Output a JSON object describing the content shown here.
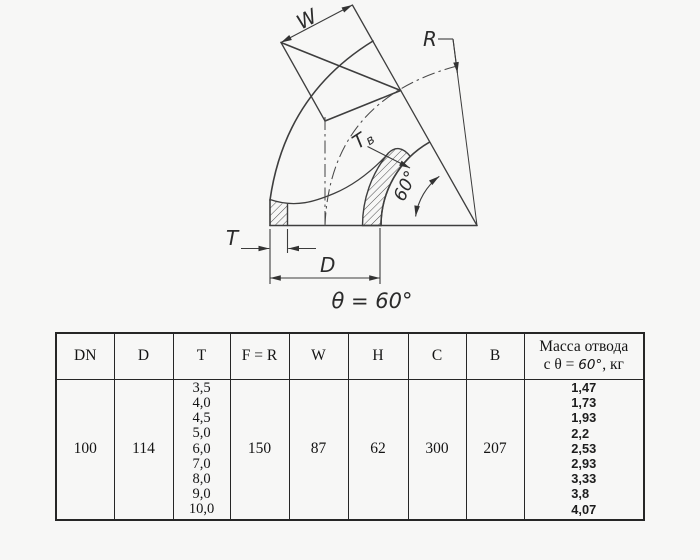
{
  "drawing": {
    "labels": {
      "w": "W",
      "r": "R",
      "t_inner_main": "T",
      "t_inner_sub": "в",
      "angle_60": "60°",
      "t": "T",
      "d": "D",
      "theta_note": "θ = 60°"
    }
  },
  "table": {
    "headers": [
      "DN",
      "D",
      "T",
      "F = R",
      "W",
      "H",
      "C",
      "B"
    ],
    "mass_header": {
      "line1": "Масса отвода",
      "line2_prefix": "с θ = ",
      "line2_angle": "60°",
      "line2_suffix": ", кг"
    },
    "row": {
      "dn": "100",
      "d": "114",
      "t_values": [
        "3,5",
        "4,0",
        "4,5",
        "5,0",
        "6,0",
        "7,0",
        "8,0",
        "9,0",
        "10,0"
      ],
      "f_r": "150",
      "w": "87",
      "h": "62",
      "c": "300",
      "b": "207",
      "mass_values": [
        "1,47",
        "1,73",
        "1,93",
        "2,2",
        "2,53",
        "2,93",
        "3,33",
        "3,8",
        "4,07"
      ]
    }
  }
}
